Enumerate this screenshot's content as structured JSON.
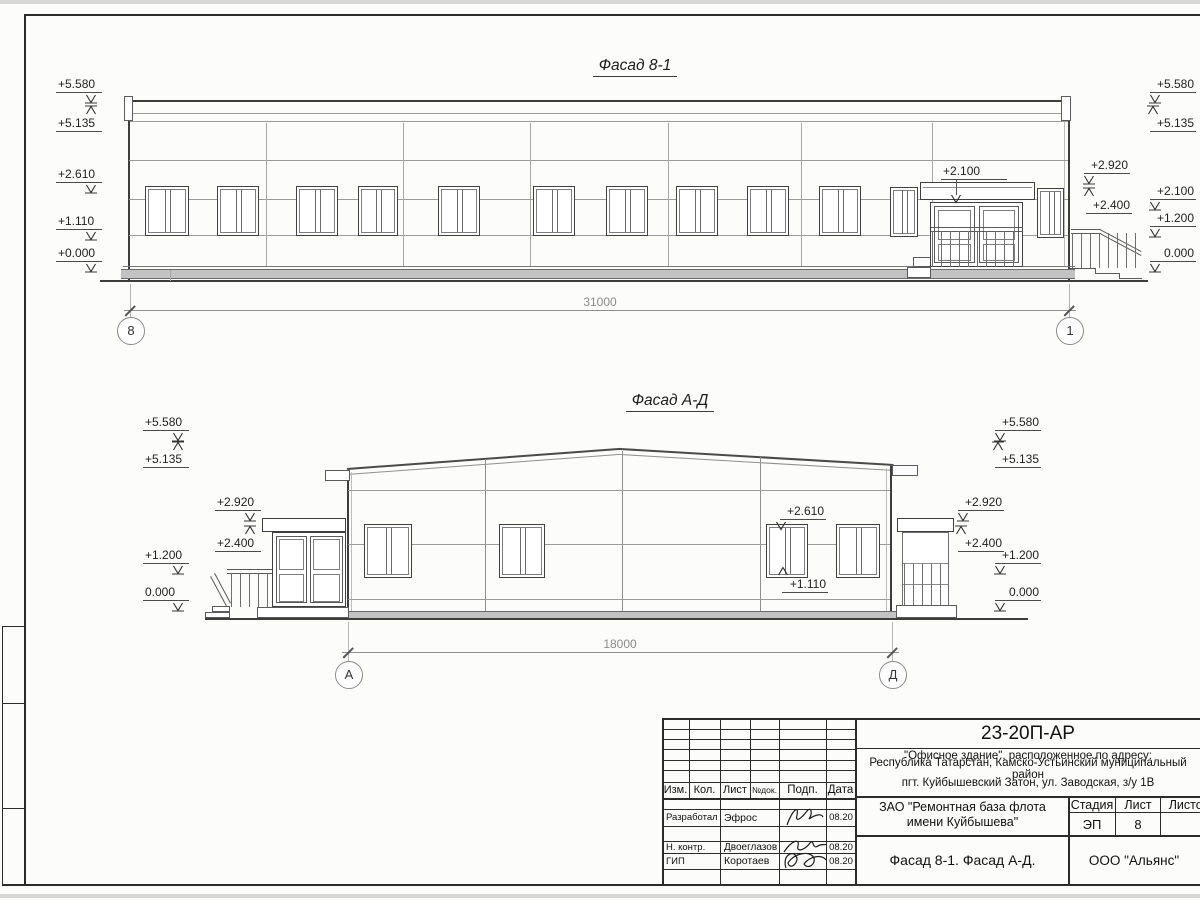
{
  "drawing": {
    "facade1": {
      "title": "Фасад 8-1",
      "dim": "31000",
      "axis_left": "8",
      "axis_right": "1",
      "canopy_level": "+2.100",
      "levels_left": [
        "+5.580",
        "+5.135",
        "+2.610",
        "+1.110",
        "+0.000"
      ],
      "levels_right_inner": [
        "+2.920",
        "+2.400"
      ],
      "levels_right": [
        "+5.580",
        "+5.135",
        "+2.100",
        "+1.200",
        "0.000"
      ]
    },
    "facade2": {
      "title": "Фасад А-Д",
      "dim": "18000",
      "axis_left": "А",
      "axis_right": "Д",
      "window_head": "+2.610",
      "window_sill": "+1.110",
      "levels_left_outer": [
        "+5.580",
        "+5.135",
        "+1.200",
        "0.000"
      ],
      "levels_left_inner": [
        "+2.920",
        "+2.400"
      ],
      "levels_right_inner": [
        "+2.920",
        "+2.400"
      ],
      "levels_right_outer": [
        "+5.580",
        "+5.135",
        "+1.200",
        "0.000"
      ]
    }
  },
  "titleblock": {
    "code": "23-20П-АР",
    "address_line1": "\"Офисное здание\", расположенное по адресу:",
    "address_line2": "Республика Татарстан, Камско-Устьинский муниципальный район",
    "address_line3": "пгт. Куйбышевский Затон, ул. Заводская, з/у 1В",
    "cols": {
      "izm": "Изм.",
      "kol": "Кол.",
      "list": "Лист",
      "ndok": "№док.",
      "podp": "Подп.",
      "data": "Дата"
    },
    "rows": [
      {
        "role": "Разработал",
        "name": "Эфрос",
        "date": "08.20"
      },
      {
        "role": "Н. контр.",
        "name": "Двоеглазов",
        "date": "08.20"
      },
      {
        "role": "ГИП",
        "name": "Коротаев",
        "date": "08.20"
      }
    ],
    "client_line1": "ЗАО \"Ремонтная база флота",
    "client_line2": "имени Куйбышева\"",
    "stage_label": "Стадия",
    "sheet_label": "Лист",
    "sheets_label": "Листов",
    "stage_value": "ЭП",
    "sheet_value": "8",
    "sheet_title": "Фасад 8-1. Фасад А-Д.",
    "company": "ООО \"Альянс\""
  }
}
